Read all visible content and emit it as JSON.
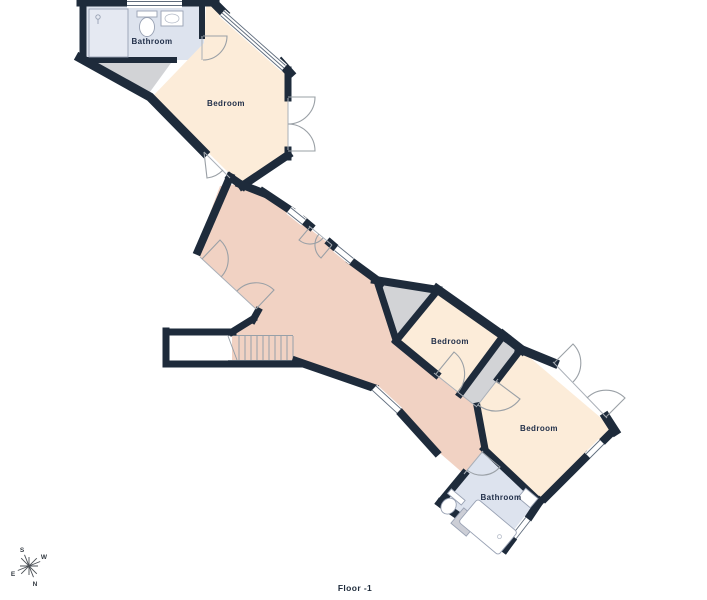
{
  "floor_plan": {
    "floor_label": "Floor -1",
    "rooms": [
      {
        "id": "bathroom-upper",
        "name": "Bathroom",
        "type": "bathroom"
      },
      {
        "id": "bedroom-upper",
        "name": "Bedroom",
        "type": "bedroom"
      },
      {
        "id": "bedroom-middle",
        "name": "Bedroom",
        "type": "bedroom"
      },
      {
        "id": "bedroom-lower",
        "name": "Bedroom",
        "type": "bedroom"
      },
      {
        "id": "bathroom-lower",
        "name": "Bathroom",
        "type": "bathroom"
      }
    ],
    "compass": {
      "north": "N",
      "south": "S",
      "east": "E",
      "west": "W"
    },
    "colors": {
      "wall": "#1e2b3b",
      "bedroom": "#fcecd9",
      "hallway": "#f1d2c3",
      "bathroom": "#dde3ee",
      "closet": "#d2d3d6",
      "background": "#ffffff"
    }
  }
}
